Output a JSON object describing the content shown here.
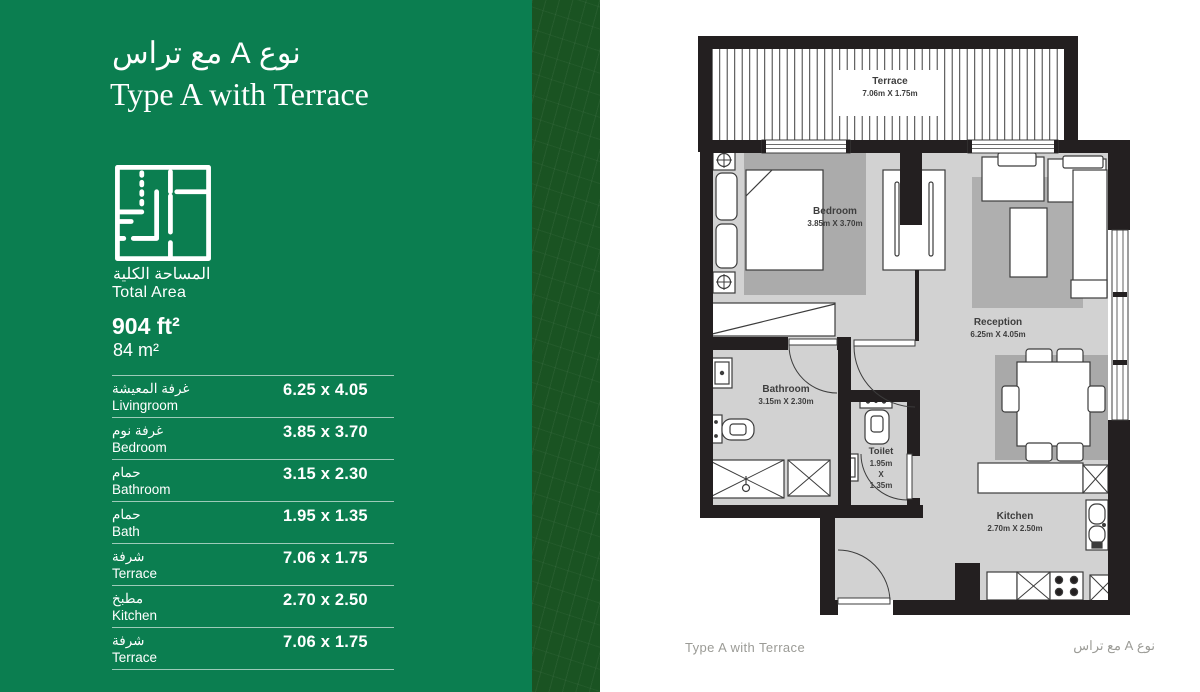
{
  "sidebar": {
    "title_ar": "نوع A مع تراس",
    "title_en": "Type A with Terrace",
    "total_area_label_ar": "المساحة الكلية",
    "total_area_label_en": "Total Area",
    "area_ft": "904 ft²",
    "area_m": "84 m²",
    "rooms": [
      {
        "ar": "غرفة المعيشة",
        "en": "Livingroom",
        "dim": "6.25 x 4.05"
      },
      {
        "ar": "غرفة نوم",
        "en": "Bedroom",
        "dim": "3.85 x 3.70"
      },
      {
        "ar": "حمام",
        "en": "Bathroom",
        "dim": "3.15 x 2.30"
      },
      {
        "ar": "حمام",
        "en": "Bath",
        "dim": "1.95 x 1.35"
      },
      {
        "ar": "شرفة",
        "en": "Terrace",
        "dim": "7.06 x 1.75"
      },
      {
        "ar": "مطبخ",
        "en": "Kitchen",
        "dim": "2.70 x 2.50"
      },
      {
        "ar": "شرفة",
        "en": "Terrace",
        "dim": "7.06 x 1.75"
      }
    ]
  },
  "floorplan": {
    "terrace": {
      "name": "Terrace",
      "dim": "7.06m X 1.75m"
    },
    "bedroom": {
      "name": "Bedroom",
      "dim": "3.85m X 3.70m"
    },
    "reception": {
      "name": "Reception",
      "dim": "6.25m X 4.05m"
    },
    "bathroom": {
      "name": "Bathroom",
      "dim": "3.15m X 2.30m"
    },
    "toilet": {
      "name": "Toilet",
      "dim_w": "1.95m",
      "dim_x": "X",
      "dim_h": "1.35m"
    },
    "kitchen": {
      "name": "Kitchen",
      "dim": "2.70m X 2.50m"
    }
  },
  "footer": {
    "left": "Type A with Terrace",
    "right": "نوع A مع تراس"
  },
  "colors": {
    "panel_green": "#0B7E50",
    "strip_green": "#1A5322",
    "wall": "#231F20",
    "floor": "#D2D2D2",
    "rug": "#ABABAB",
    "footer_text": "#9B9B96"
  }
}
